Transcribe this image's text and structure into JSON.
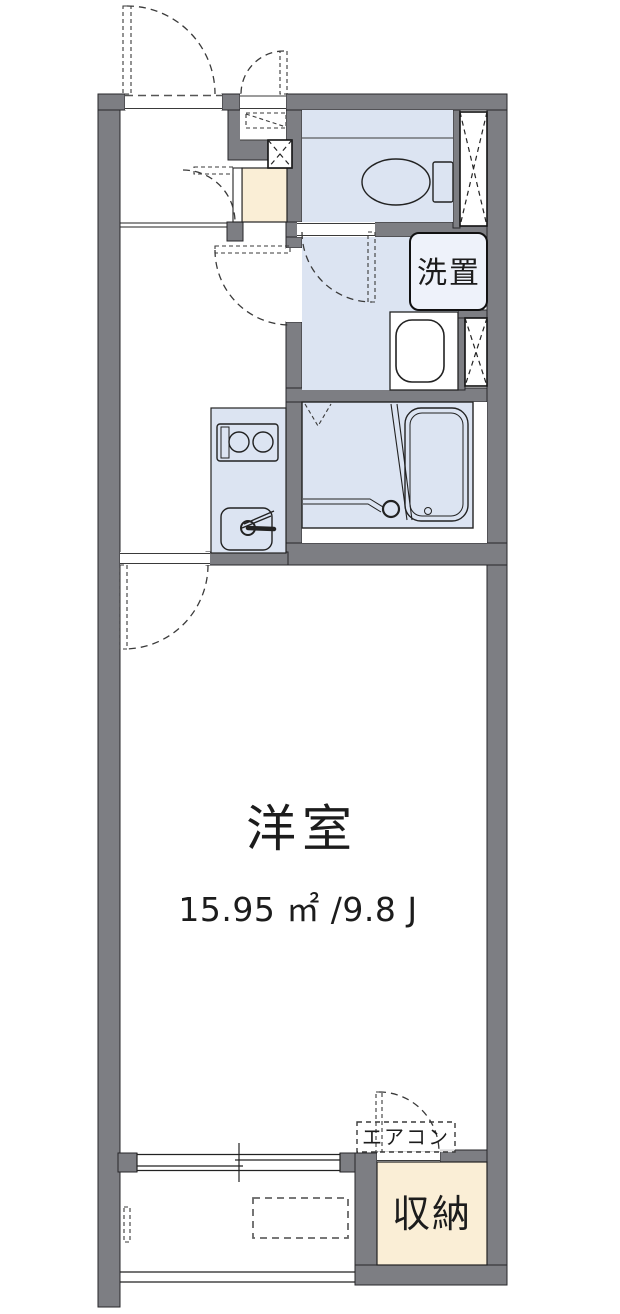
{
  "floorplan": {
    "rooms": {
      "western_room": {
        "name": "洋室",
        "area": "15.95 ㎡ /9.8 J"
      },
      "storage": {
        "name": "収納"
      },
      "laundry_space": {
        "name": "洗置"
      },
      "air_conditioner": {
        "name": "エアコン"
      }
    },
    "colors": {
      "wall": "#7d7e83",
      "wet_area": "#dce4f2",
      "fixture_fill": "#eef2fa",
      "bath_fill": "#e4eaf6",
      "storage_fill": "#faeed6"
    }
  }
}
